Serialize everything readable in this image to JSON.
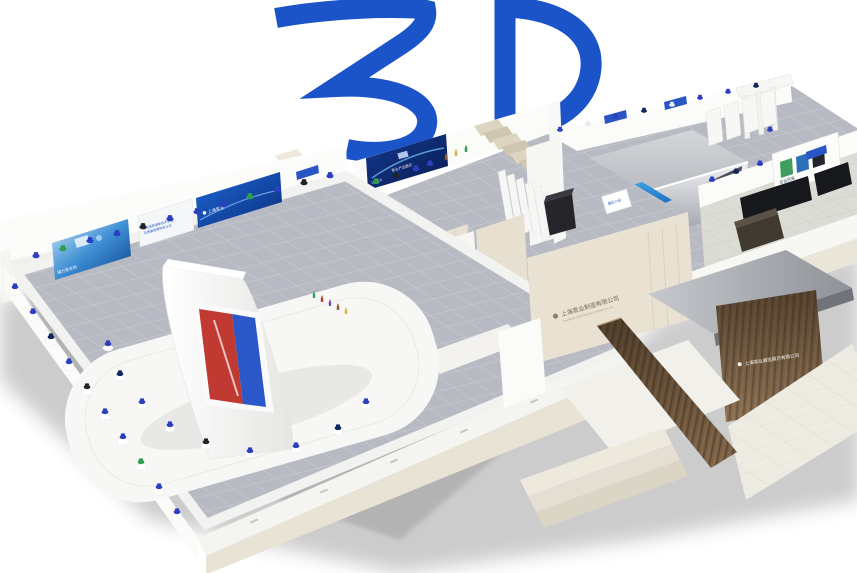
{
  "view": {
    "type": "3d-exhibition-hall-preview",
    "background": "#ffffff"
  },
  "logo": {
    "text": "3D",
    "color": "#1b53c8"
  },
  "palette": {
    "floor_tile": "#b7bac2",
    "wall": "#fbfbf9",
    "platform_face": "#e8e3d4",
    "travertine": "#e9e2d3",
    "wood": "#8a6f52",
    "accent_blue": "#2a55c4",
    "banner_navy": "#0d2f7e",
    "screen_red": "#c03a32",
    "screen_blue": "#2b57c8"
  },
  "halls": {
    "left_hall": {
      "banners": {
        "product_banner": {
          "label": "磁力泵系列"
        },
        "certificate_banner": {
          "line1": "公司荣获高新技术企业",
          "line2": "及质量管理体系认证"
        },
        "brand_banner": {
          "label": "上海泵业"
        }
      }
    },
    "back_hall": {
      "banner": {
        "brand": "上海泵业",
        "title": "泵业产品展示"
      },
      "info_sign": {
        "label": "展区介绍"
      }
    },
    "corridor": {
      "sign": {
        "label": "参观指引"
      }
    },
    "entrance": {
      "stone_wall_sign": {
        "name": "上海泵业制造有限公司",
        "caption": "SHANGHAI PUMP MANUFACTURING CO.,LTD."
      },
      "reception_sign": {
        "name": "上海泵业展览展示有限公司"
      }
    },
    "right_wing": {
      "board": {
        "label": "企业风采"
      }
    }
  }
}
